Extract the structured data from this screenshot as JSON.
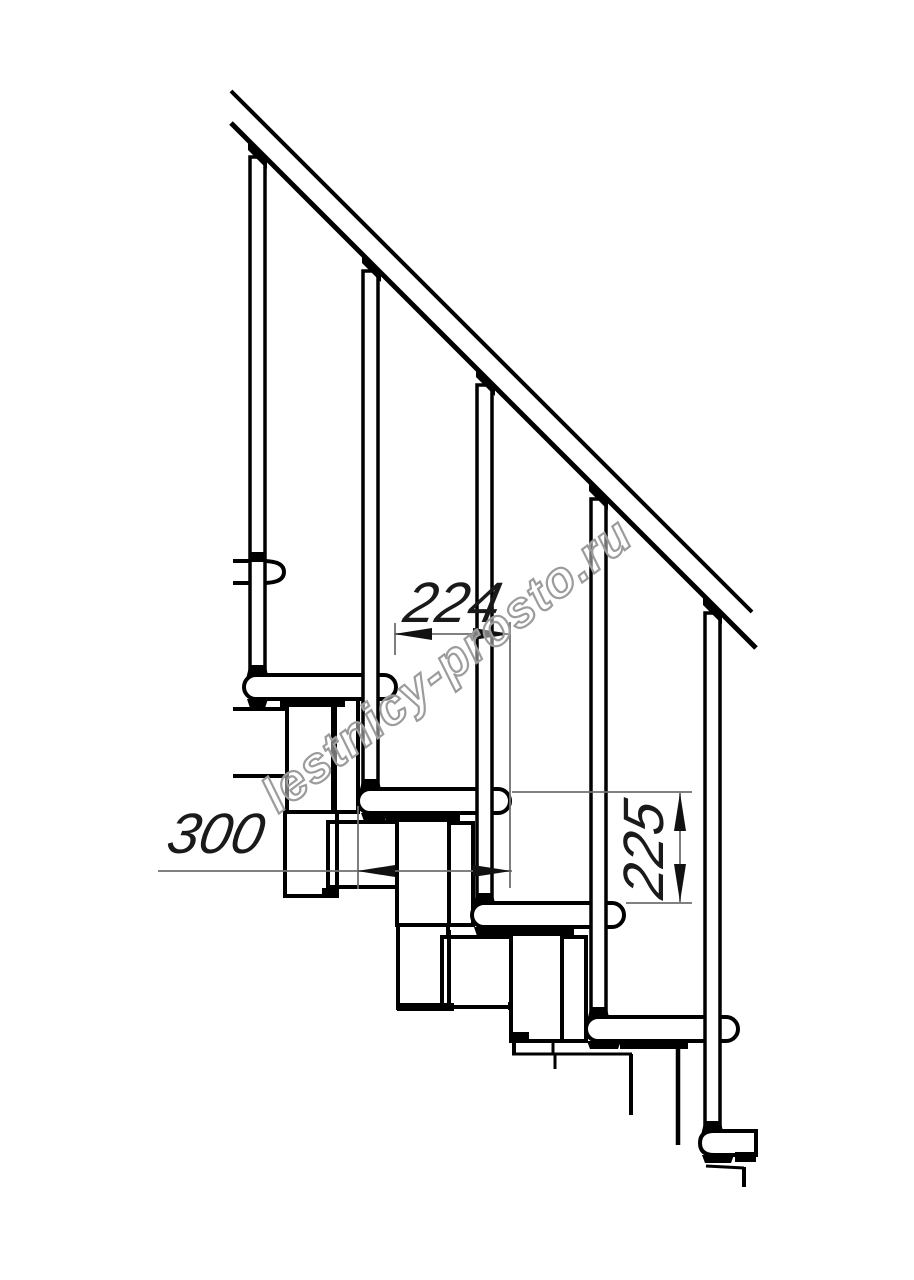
{
  "drawing": {
    "watermark_text": "lestnicy-prosto.ru",
    "dimension_labels": {
      "step_pitch": "224",
      "tread_depth": "300",
      "step_rise": "225"
    },
    "colors": {
      "outline": "#000000",
      "dimension_line": "#6f6f6f",
      "watermark_stroke": "#9c9c9c",
      "fill": "#ffffff"
    },
    "structure": {
      "steps": 5,
      "balusters": 5,
      "handrails": 1
    }
  }
}
